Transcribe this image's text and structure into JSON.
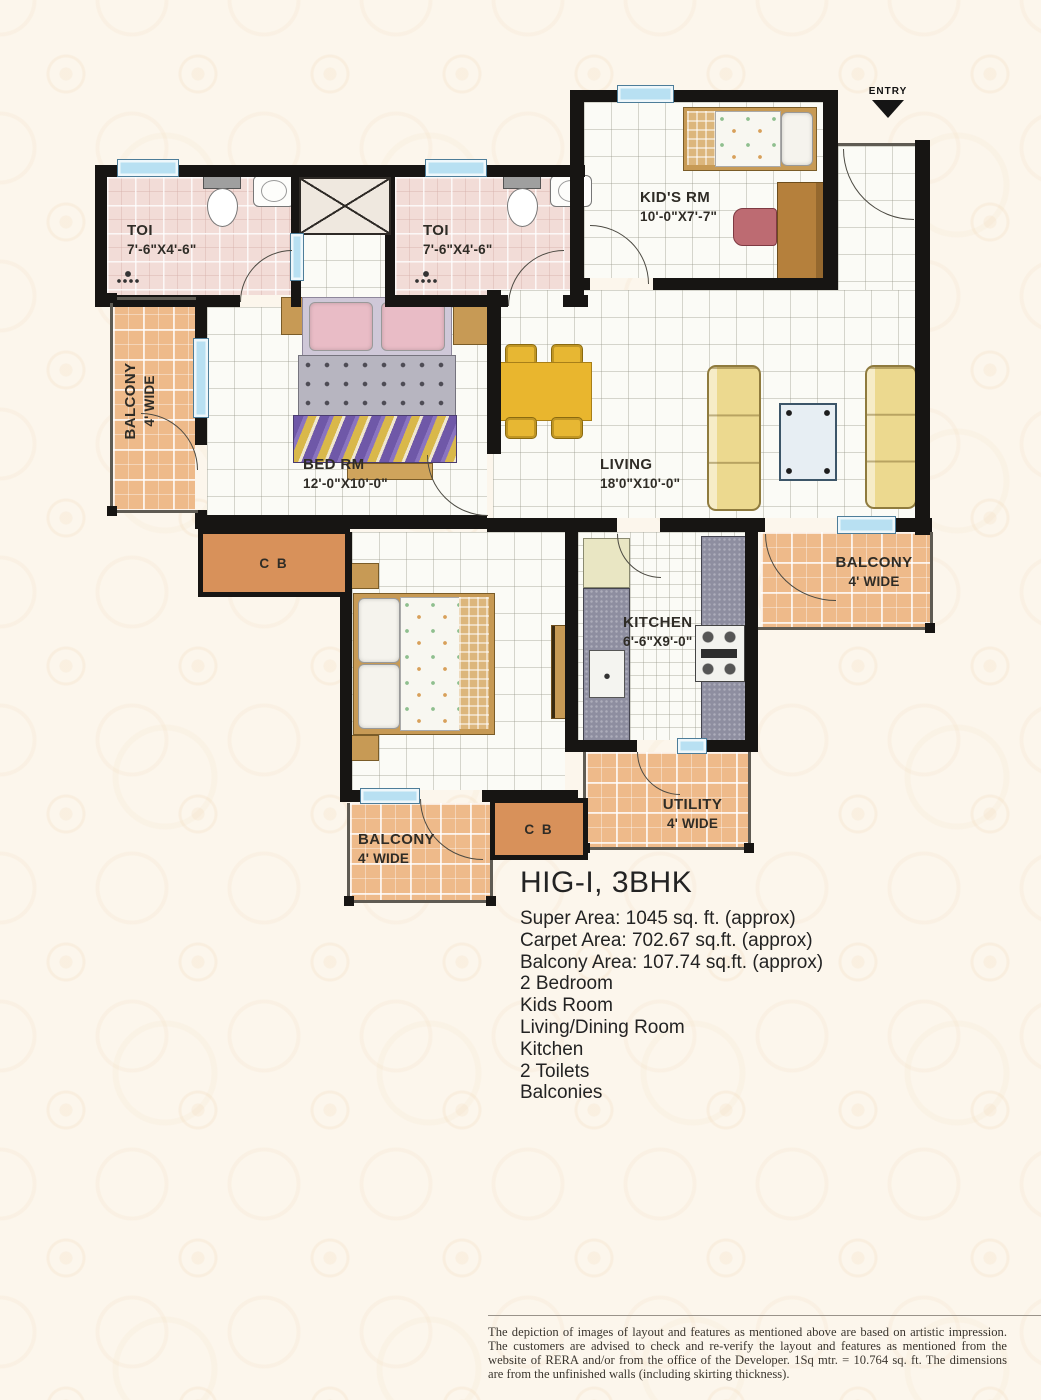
{
  "plan": {
    "entry_label": "ENTRY",
    "rooms": {
      "toilet1": {
        "name": "TOI",
        "dim": "7'-6\"X4'-6\""
      },
      "toilet2": {
        "name": "TOI",
        "dim": "7'-6\"X4'-6\""
      },
      "kids": {
        "name": "KID'S RM",
        "dim": "10'-0\"X7'-7\""
      },
      "bedroom1": {
        "name": "BED RM",
        "dim": "12'-0\"X10'-0\""
      },
      "living": {
        "name": "LIVING",
        "dim": "18'0\"X10'-0\""
      },
      "kitchen": {
        "name": "KITCHEN",
        "dim": "6'-6\"X9'-0\""
      },
      "utility": {
        "name": "UTILITY",
        "dim": "4' WIDE"
      },
      "balcony_left": {
        "name": "BALCONY",
        "dim": "4' WIDE"
      },
      "balcony_right": {
        "name": "BALCONY",
        "dim": "4' WIDE"
      },
      "balcony_bottom": {
        "name": "BALCONY",
        "dim": "4' WIDE"
      },
      "cupboard1": {
        "name": "C B"
      },
      "cupboard2": {
        "name": "C B"
      }
    },
    "colors": {
      "wall": "#171513",
      "window": "#b8e0f2",
      "toilet_floor": "#f2dcd7",
      "balcony_floor": "#eeba8a",
      "cupboard": "#d8915a",
      "counter": "#8e8ea0",
      "sofa": "#ecd98f",
      "dining": "#e7b733"
    }
  },
  "title_block": {
    "title": "HIG-I, 3BHK",
    "lines": [
      "Super Area: 1045 sq. ft. (approx)",
      "Carpet Area: 702.67 sq.ft. (approx)",
      "Balcony Area: 107.74 sq.ft. (approx)",
      "2 Bedroom",
      "Kids Room",
      "Living/Dining Room",
      "Kitchen",
      "2 Toilets",
      "Balconies"
    ]
  },
  "disclaimer": "The depiction of images of layout and features as mentioned above are based on artistic impression. The customers are advised to check and re-verify the layout and features as mentioned from the website of RERA and/or from the office of the Developer. 1Sq mtr. = 10.764 sq. ft. The dimensions are from the unfinished walls (including skirting thickness)."
}
